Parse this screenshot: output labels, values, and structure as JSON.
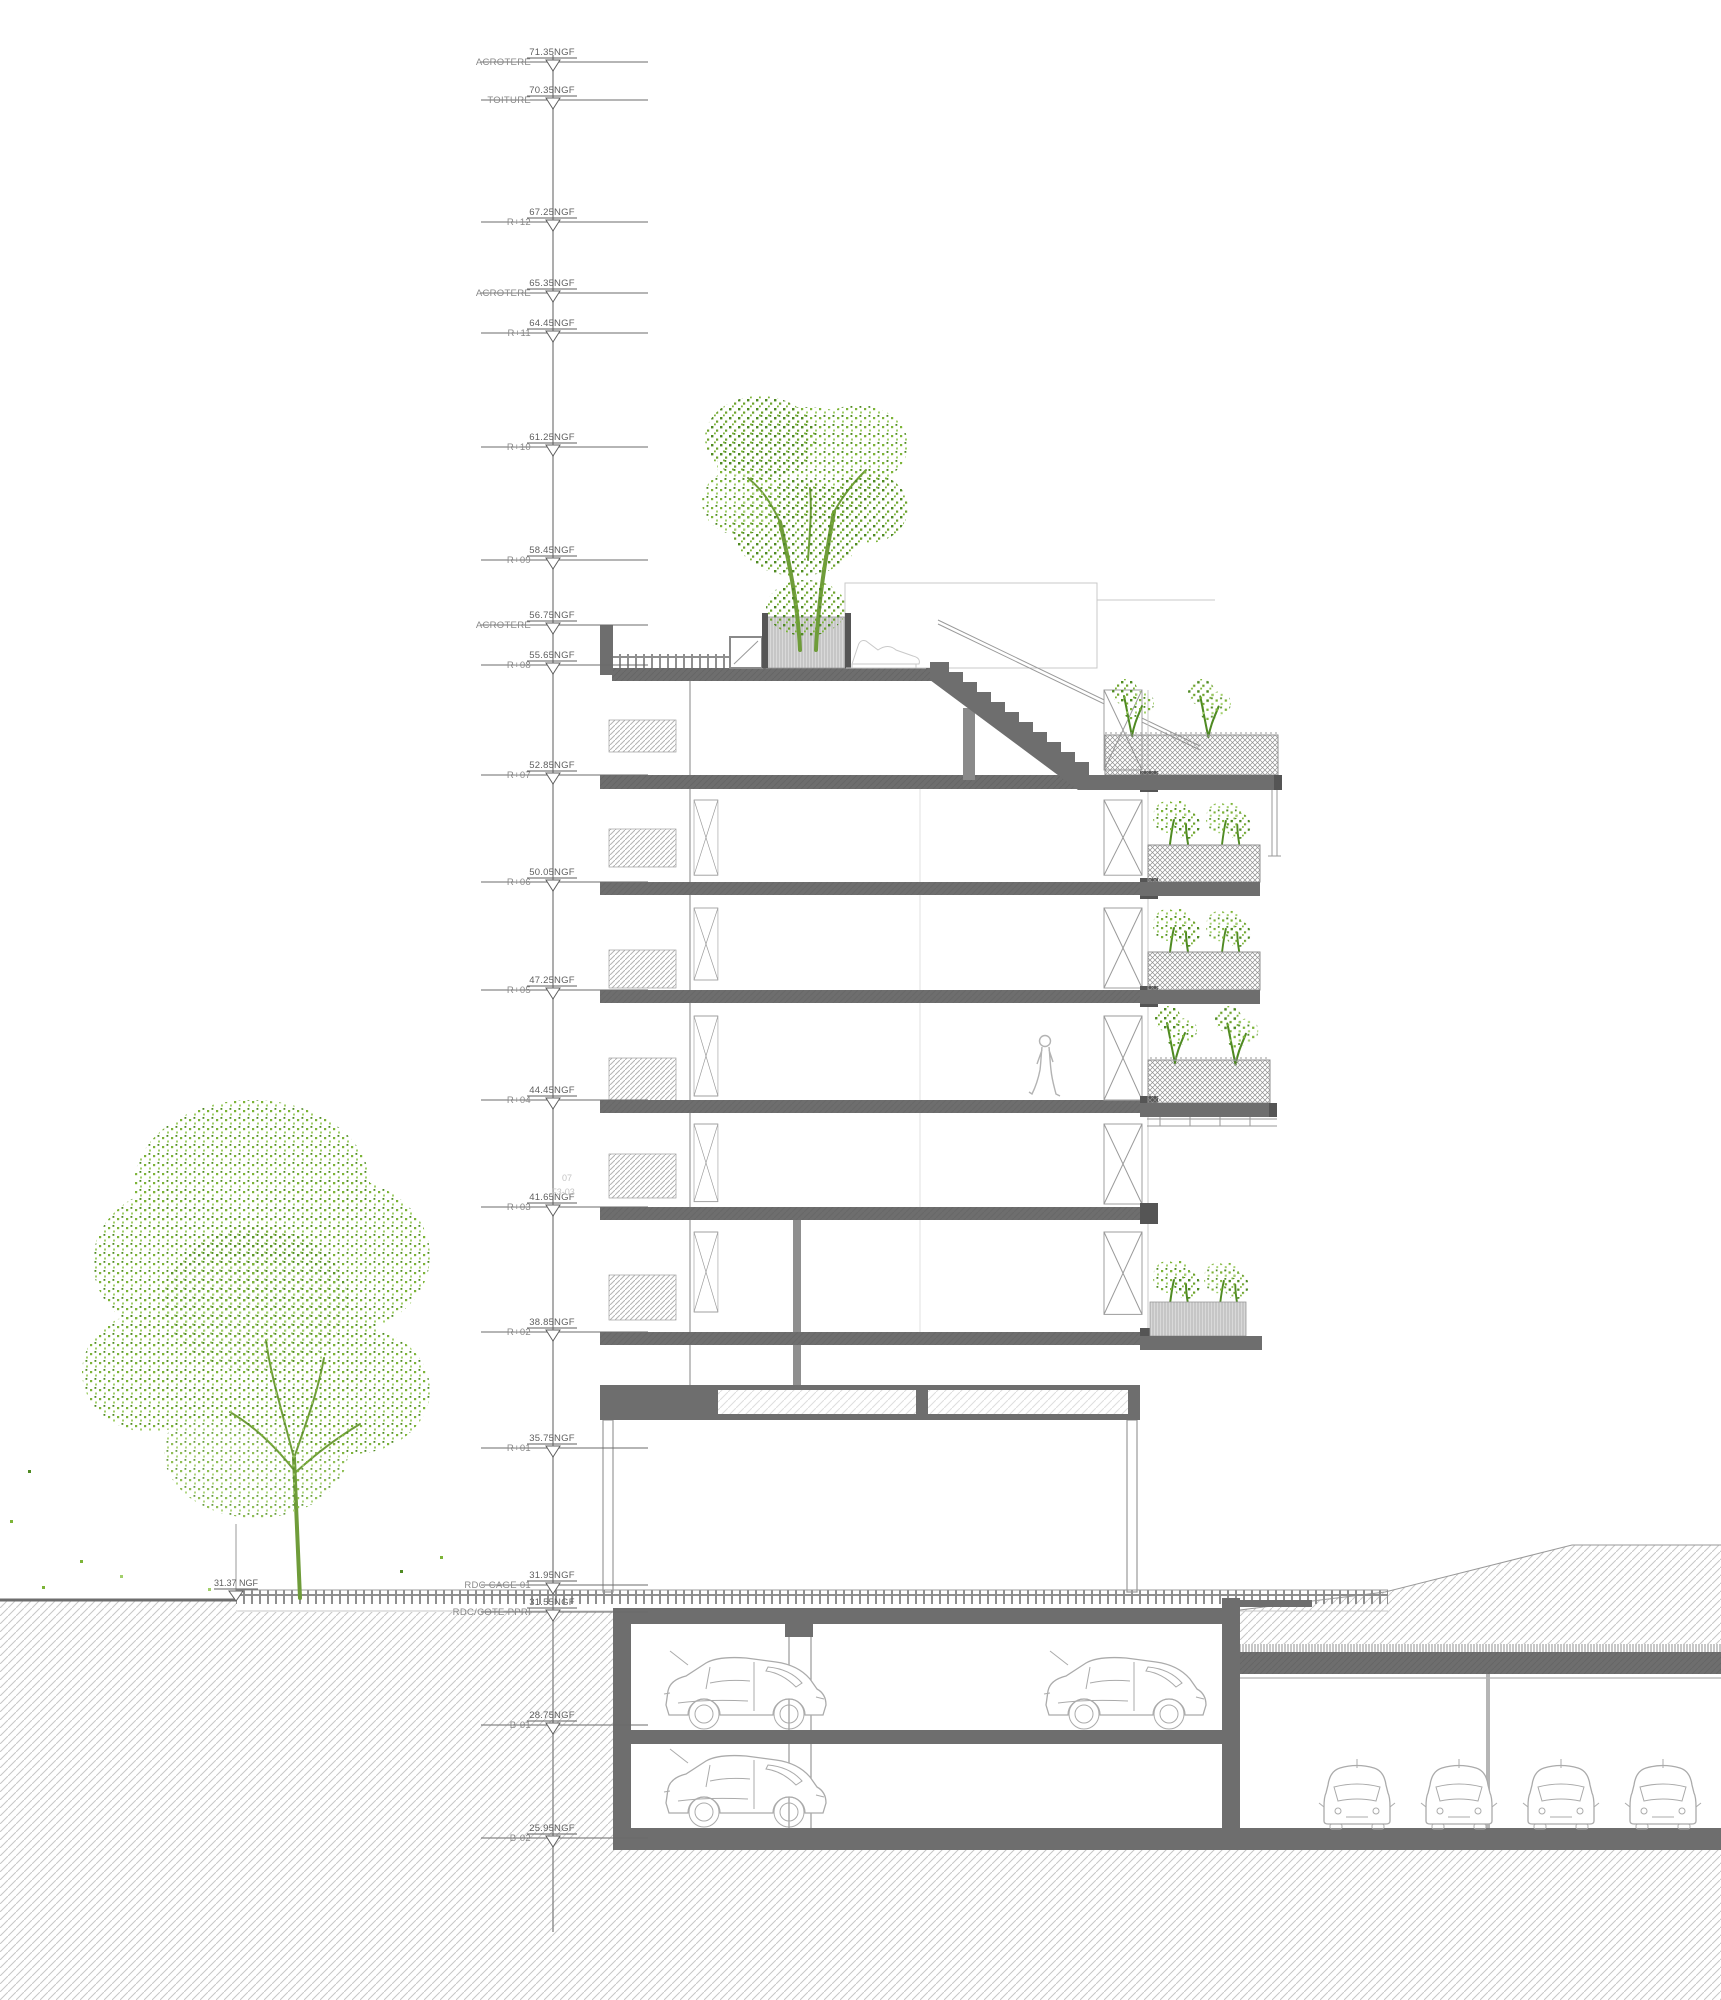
{
  "drawing_type": "architectural-building-section",
  "levels": [
    {
      "name": "ACROTERE",
      "value": "71.35NGF",
      "y": 62
    },
    {
      "name": "TOITURE",
      "value": "70.35NGF",
      "y": 100
    },
    {
      "name": "R+12",
      "value": "67.25NGF",
      "y": 222
    },
    {
      "name": "ACROTERE",
      "value": "65.35NGF",
      "y": 293
    },
    {
      "name": "R+11",
      "value": "64.45NGF",
      "y": 333
    },
    {
      "name": "R+10",
      "value": "61.25NGF",
      "y": 447
    },
    {
      "name": "R+09",
      "value": "58.45NGF",
      "y": 560
    },
    {
      "name": "ACROTERE",
      "value": "56.75NGF",
      "y": 625
    },
    {
      "name": "R+08",
      "value": "55.65NGF",
      "y": 665
    },
    {
      "name": "R+07",
      "value": "52.85NGF",
      "y": 775
    },
    {
      "name": "R+06",
      "value": "50.05NGF",
      "y": 882
    },
    {
      "name": "R+05",
      "value": "47.25NGF",
      "y": 990
    },
    {
      "name": "R+04",
      "value": "44.45NGF",
      "y": 1100
    },
    {
      "name": "R+03",
      "value": "41.65NGF",
      "y": 1207
    },
    {
      "name": "R+02",
      "value": "38.85NGF",
      "y": 1332
    },
    {
      "name": "R+01",
      "value": "35.75NGF",
      "y": 1448
    },
    {
      "name": "RDC CAGE 01",
      "value": "31.95NGF",
      "y": 1585
    },
    {
      "name": "RDC/COTE PPRI",
      "value": "31.55NGF",
      "y": 1612
    },
    {
      "name": "B-01",
      "value": "28.75NGF",
      "y": 1725
    },
    {
      "name": "B-02",
      "value": "25.95NGF",
      "y": 1838
    }
  ],
  "ground_marker": {
    "label": "31.37 NGF"
  },
  "unit_annotation": {
    "line1": "07",
    "line2": "F3-03"
  },
  "colors": {
    "slab": "#6e6e6e",
    "slabdark": "#555555",
    "walllight": "#9a9a9a",
    "hatch": "#c7c7c7",
    "mesh": "#8f8f8f",
    "tick": "#8f8f8f",
    "faint": "#c9c9c9",
    "car": "#ababab",
    "person": "#b3b3b3",
    "text": "#5f5f5f",
    "textfaint": "#c4c4c4",
    "levelline": "#6b6b6b",
    "green": "#7cb437",
    "greenlight": "#a2cf6b",
    "greendark": "#4f8a22",
    "trunk": "#6f9c3a",
    "planter": "#d9d9d9"
  }
}
